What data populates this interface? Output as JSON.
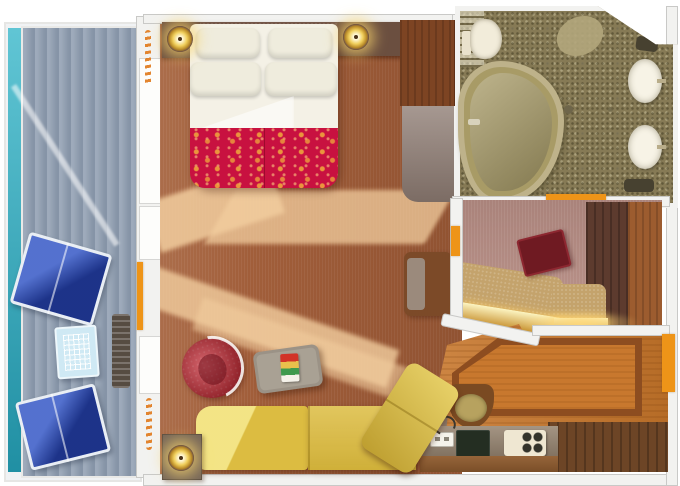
{
  "scene": {
    "kind": "floor-plan",
    "subject": "cruise-ship-suite-with-private-balcony",
    "view": "top-down-3d-rendering",
    "text_labels": []
  },
  "rooms": [
    {
      "id": "balcony",
      "label": "balcony"
    },
    {
      "id": "bedroom-living",
      "label": "combined bedroom and living room"
    },
    {
      "id": "bathroom",
      "label": "bathroom with tub and double sinks"
    },
    {
      "id": "dressing-area",
      "label": "vanity dressing area"
    },
    {
      "id": "entry-foyer",
      "label": "entry foyer with bar counter"
    }
  ],
  "furniture": [
    "lounge-chair-upper",
    "lounge-chair-lower",
    "balcony-glass-table",
    "balcony-deck-chair",
    "king-bed-with-four-pillows",
    "red-gold-foot-runner",
    "nightstand-left",
    "nightstand-right",
    "bedside-lamp-left",
    "bedside-lamp-right",
    "wardrobe",
    "dresser",
    "wall-bench",
    "red-barrel-armchair",
    "stone-coffee-table",
    "magazine",
    "yellow-sectional-sofa",
    "yellow-chaise-section",
    "end-table-with-lamp",
    "vanity-counter-gold-front",
    "red-vanity-stool",
    "closet-units",
    "bathtub",
    "toilet",
    "bath-shelves",
    "bath-rug",
    "vanity-sink-upper",
    "vanity-sink-lower",
    "wood-floor-inlay",
    "bar-basin",
    "kitchen-counter",
    "cooktop",
    "espresso-machine",
    "power-outlet",
    "cord",
    "balcony-door",
    "bathroom-door",
    "dressing-door",
    "entry-door"
  ],
  "palette": {
    "sea": "#2bb2c6",
    "deck": "#93a1b3",
    "deck_chair": "#564c42",
    "glass_table": "#cfe9f4",
    "lounger": "#2e52c4",
    "wall": "#f2f2f0",
    "door_accent": "#ee9418",
    "carpet_main": "#a15e3a",
    "carpet_dressing": "#b88e85",
    "sunlight": "#f2cd9e",
    "headboard": "#76594a",
    "nightstand": "#6b4f40",
    "bed_linen": "#f4f1e6",
    "bed_runner": "#c81140",
    "wardrobe": "#7d4423",
    "dresser": "#8d7b72",
    "sofa": "#dcbc41",
    "armchair": "#c3242f",
    "stool": "#6f1a22",
    "end_table": "#776759",
    "bathroom_floor": "#867a55",
    "tub": "#a89b66",
    "porcelain": "#f7f3e6",
    "closet_dark": "#5d3b2e",
    "closet_wood": "#9c5c2f",
    "vanity_top": "#c4a36c",
    "vanity_gold": "#eebc4e",
    "wood_floor": "#c8782e",
    "wood_inlay": "#8d4d20",
    "wood_dark": "#6d4526",
    "counter": "#95836f"
  }
}
